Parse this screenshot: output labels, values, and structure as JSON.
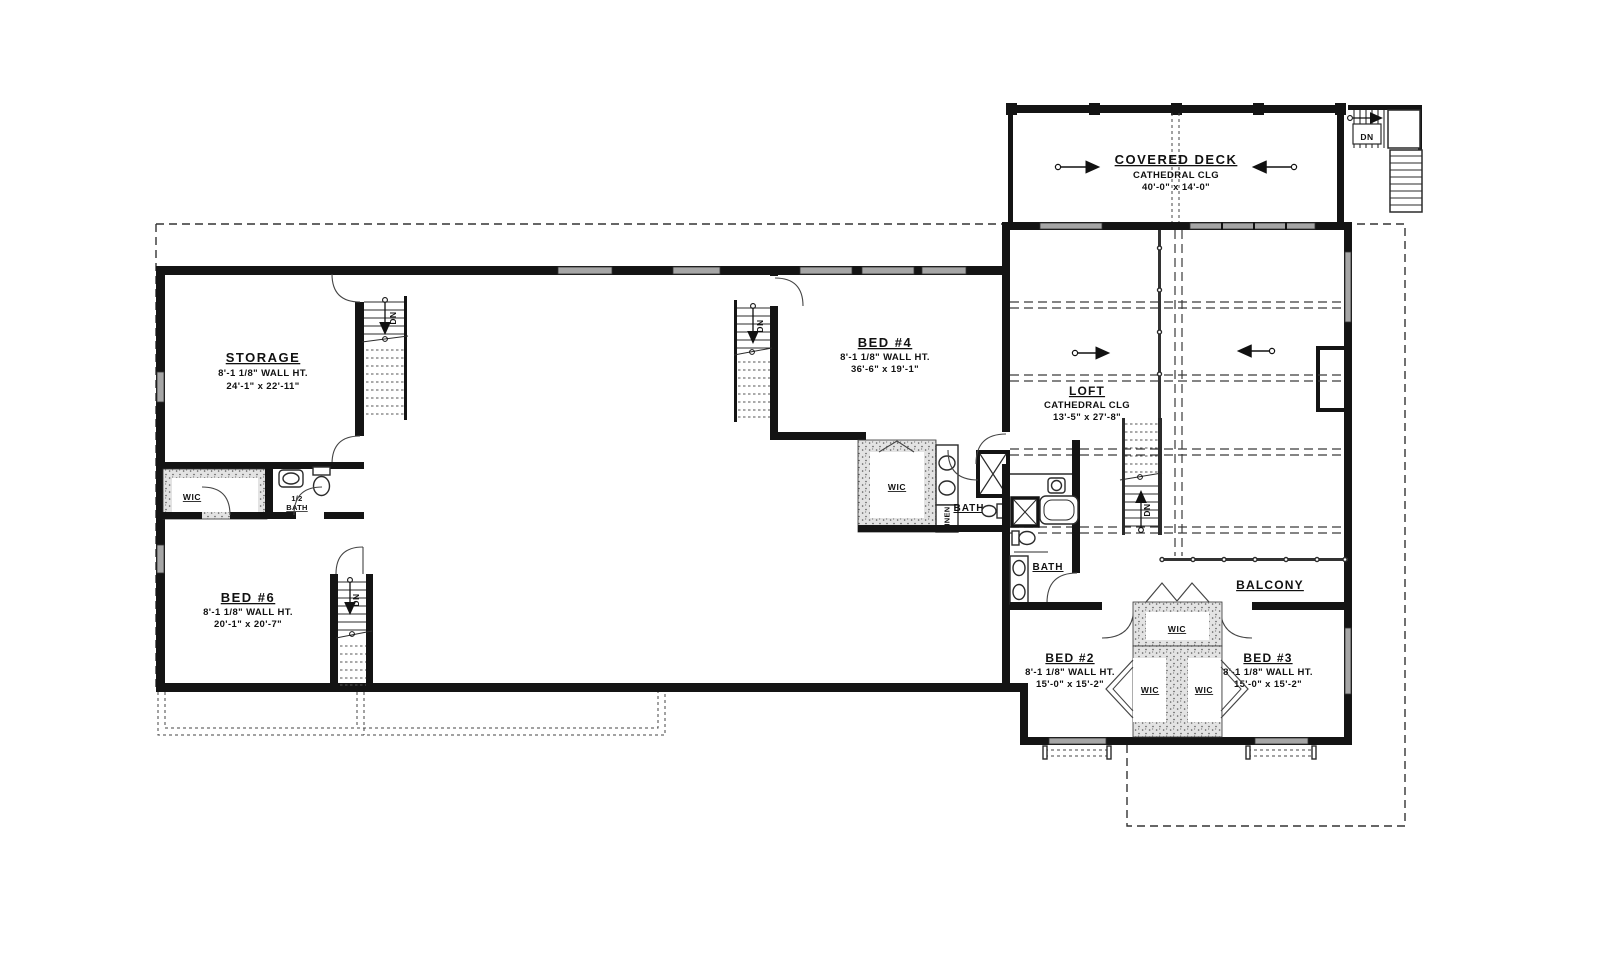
{
  "plan": {
    "covered_deck": {
      "name": "COVERED DECK",
      "clg": "CATHEDRAL CLG",
      "dims": "40'-0\" x 14'-0\""
    },
    "storage": {
      "name": "STORAGE",
      "wall": "8'-1 1/8\" WALL HT.",
      "dims": "24'-1\" x 22'-11\""
    },
    "bed6": {
      "name": "BED #6",
      "wall": "8'-1 1/8\" WALL HT.",
      "dims": "20'-1\" x 20'-7\""
    },
    "bed4": {
      "name": "BED #4",
      "wall": "8'-1 1/8\" WALL HT.",
      "dims": "36'-6\" x 19'-1\""
    },
    "loft": {
      "name": "LOFT",
      "clg": "CATHEDRAL CLG",
      "dims": "13'-5\" x 27'-8\""
    },
    "balcony": {
      "name": "BALCONY"
    },
    "bed2": {
      "name": "BED #2",
      "wall": "8'-1 1/8\" WALL HT.",
      "dims": "15'-0\" x 15'-2\""
    },
    "bed3": {
      "name": "BED #3",
      "wall": "8'-1 1/8\" WALL HT.",
      "dims": "15'-0\" x 15'-2\""
    },
    "labels": {
      "wic": "WIC",
      "bath": "BATH",
      "linen": "LINEN",
      "dn": "DN",
      "half_bath_1": "1/2",
      "half_bath_2": "BATH"
    }
  }
}
